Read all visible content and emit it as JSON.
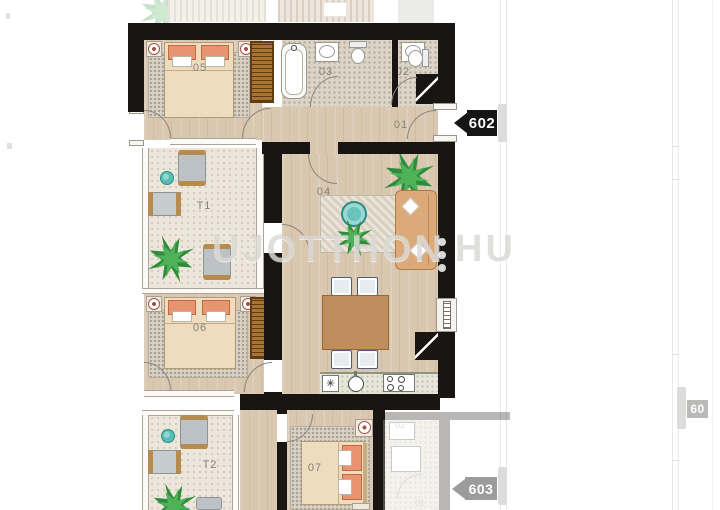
{
  "watermark": {
    "left": "UJOTTHON",
    "right": "HU"
  },
  "badges": {
    "b602": "602",
    "b603": "603",
    "b60": "60"
  },
  "rooms": {
    "r01": "01",
    "r02": "02",
    "r03": "03",
    "r04": "04",
    "r05": "05",
    "r06": "06",
    "r07": "07",
    "t1": "T1",
    "t2": "T2"
  },
  "neighbor": {
    "n02": "02",
    "n01": "01"
  },
  "kitchen": {
    "dishwasher_symbol": "✳"
  },
  "colors": {
    "wall": "#181512",
    "wood_floor": "#d9c7b0",
    "terrace_floor": "#ece6db",
    "carpet": "#d8d2c6",
    "accent_teal": "#58bdb6",
    "plant_green": "#2f8c3a",
    "sofa_tan": "#dcaa79",
    "table_wood": "#c08e5e",
    "pillow_pink": "#e9946f",
    "wardrobe_brown": "#a8742f",
    "badge_bg": "#151515"
  }
}
